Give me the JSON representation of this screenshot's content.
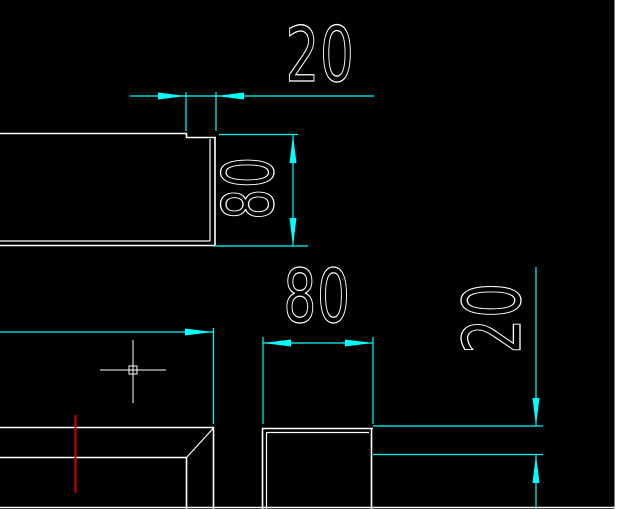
{
  "colors": {
    "background": "#000000",
    "geometry": "#ffffff",
    "dimension": "#00ffff",
    "marker": "#d40000",
    "panel": "#ffffff"
  },
  "dimensions": {
    "top_step_width": {
      "label": "20",
      "orientation": "horizontal"
    },
    "plate_height": {
      "label": "80",
      "orientation": "vertical"
    },
    "lower_width": {
      "label": "80",
      "orientation": "horizontal"
    },
    "right_step_height": {
      "label": "20",
      "orientation": "vertical"
    }
  },
  "cursor": {
    "type": "crosshair-with-pickbox"
  }
}
